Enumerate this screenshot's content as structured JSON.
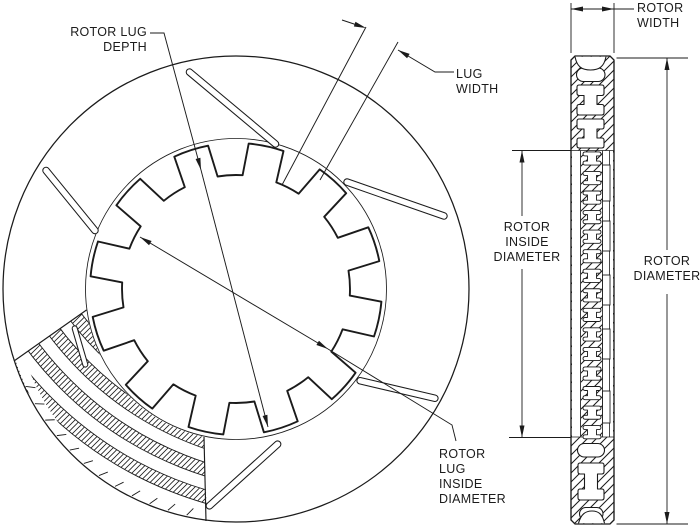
{
  "colors": {
    "ink": "#1b1b1b",
    "paper": "#ffffff"
  },
  "labels": {
    "rotor_lug_depth": {
      "lines": [
        "ROTOR LUG",
        "DEPTH"
      ]
    },
    "lug_width": {
      "lines": [
        "LUG",
        "WIDTH"
      ]
    },
    "rotor_width": {
      "lines": [
        "ROTOR",
        "WIDTH"
      ]
    },
    "rotor_inside_diameter": {
      "lines": [
        "ROTOR",
        "INSIDE",
        "DIAMETER"
      ]
    },
    "rotor_diameter": {
      "lines": [
        "ROTOR",
        "DIAMETER"
      ]
    },
    "rotor_lug_inside_diameter": {
      "lines": [
        "ROTOR",
        "LUG",
        "INSIDE",
        "DIAMETER"
      ]
    }
  }
}
